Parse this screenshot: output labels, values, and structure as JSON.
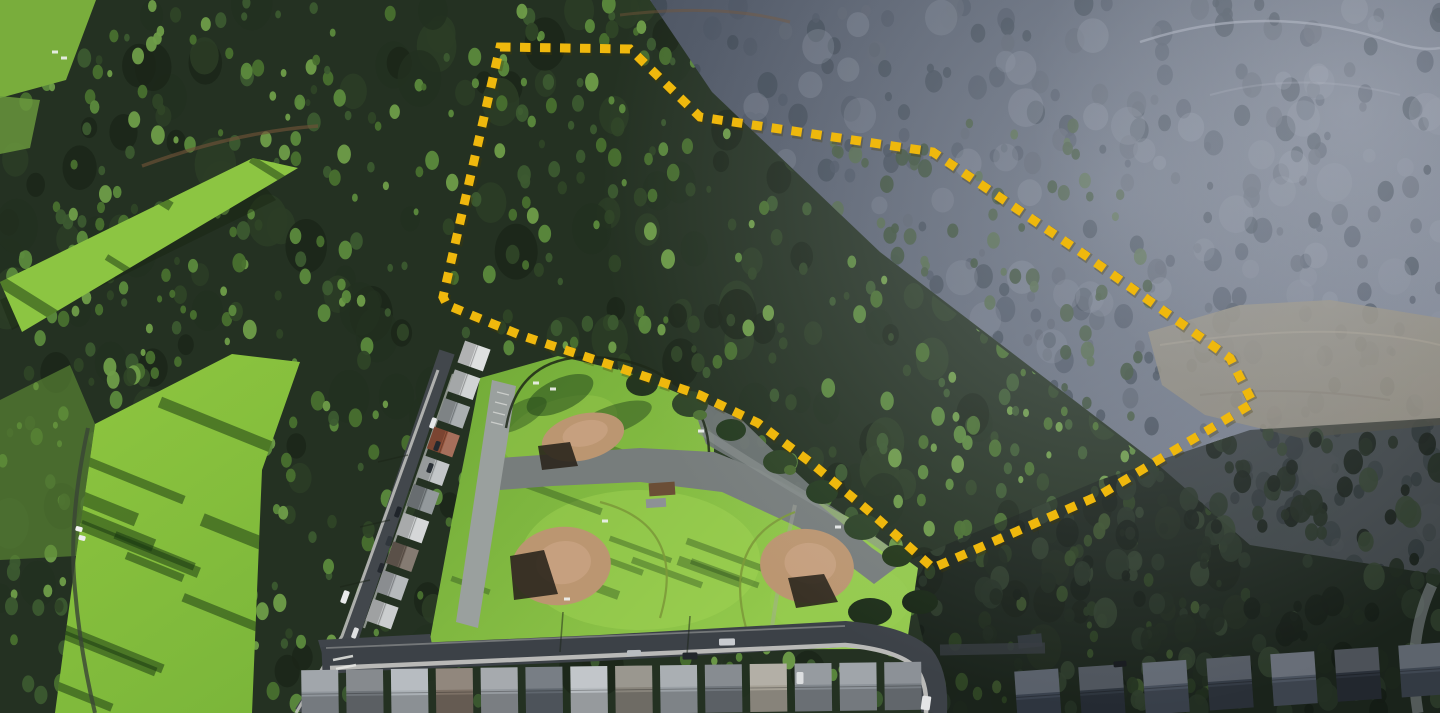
{
  "scene": {
    "type": "aerial-drone-photo",
    "description": "Low-sun aerial photo of a forested hillside parcel outlined with a yellow dashed boundary, above a community ballpark, golf-course fairways and suburban streets",
    "canvas": {
      "width": 1440,
      "height": 713
    }
  },
  "overlay": {
    "boundary": {
      "name": "parcel-boundary",
      "style": "dashed",
      "color": "#efb80d",
      "shadow_color": "#4a3c00",
      "stroke_width": 9,
      "dash_pattern": "10.5 9.5",
      "points": "500,47 630,49 700,117 933,152 1085,255 1230,358 1253,403 1100,495 933,568 870,512 810,462 758,423 700,395 620,368 520,335 447,305 443,297"
    }
  },
  "landmarks": {
    "forest": {
      "label": "dense conifer forest",
      "coverage": "left and center"
    },
    "hillside": {
      "label": "hazy chaparral hillside",
      "coverage": "upper right"
    },
    "bare_patch": {
      "label": "graded bare slope",
      "points": "1148,332 1240,305 1330,300 1440,318 1440,425 1300,438 1205,415 1162,385"
    },
    "golf_course": {
      "label": "golf fairways with tree shadows",
      "fairway_count": 2,
      "cart_count": 2
    },
    "ballpark": {
      "label": "community ballpark",
      "dirt_color": "#bb9671",
      "dirt_light": "#cfa98a",
      "diamonds": [
        {
          "name": "upper-infield",
          "cx": 583,
          "cy": 437,
          "rx": 42,
          "ry": 23,
          "rot": -14
        },
        {
          "name": "lower-left-infield",
          "cx": 561,
          "cy": 566,
          "rx": 50,
          "ry": 39,
          "rot": -8
        },
        {
          "name": "lower-right-infield",
          "cx": 807,
          "cy": 566,
          "rx": 47,
          "ry": 37,
          "rot": 6
        }
      ],
      "backstops": [
        {
          "points": "510,556 544,550 558,594 514,600"
        },
        {
          "points": "788,578 824,574 838,602 796,608"
        },
        {
          "points": "538,446 570,442 578,466 542,470"
        }
      ],
      "sheds": [
        {
          "x": 662,
          "y": 489,
          "w": 26,
          "h": 13,
          "a": -4,
          "c": "#6b4e36"
        },
        {
          "x": 656,
          "y": 503,
          "w": 20,
          "h": 9,
          "a": -4,
          "c": "#8d9195"
        },
        {
          "x": 1030,
          "y": 641,
          "w": 24,
          "h": 13,
          "a": -6,
          "c": "#2e353a"
        }
      ],
      "white_specks": [
        [
          536,
          383
        ],
        [
          553,
          389
        ],
        [
          697,
          400
        ],
        [
          701,
          431
        ],
        [
          605,
          521
        ],
        [
          838,
          527
        ],
        [
          567,
          599
        ],
        [
          55,
          52
        ],
        [
          64,
          58
        ]
      ]
    },
    "house_rows": [
      {
        "name": "bottom-street-row",
        "start": [
          320,
          694
        ],
        "end": [
          903,
          686
        ],
        "count": 14,
        "frontage": 37,
        "depth": 48,
        "angle": -0.8,
        "colors": [
          "#8f959b",
          "#6f7479",
          "#aab0b5",
          "#7c7065",
          "#959a9f",
          "#5f666e",
          "#b7bcc0",
          "#87837a",
          "#9aa0a5",
          "#70767c",
          "#a5a095",
          "#82888e",
          "#8e949a",
          "#777d83"
        ]
      },
      {
        "name": "shaded-right-row",
        "start": [
          1038,
          696
        ],
        "end": [
          1422,
          670
        ],
        "count": 7,
        "frontage": 44,
        "depth": 52,
        "angle": -4,
        "colors": [
          "#39414d",
          "#2d343d",
          "#454d59",
          "#333a44",
          "#4a525e",
          "#2a3039",
          "#3f4752"
        ]
      },
      {
        "name": "side-street-row",
        "start": [
          474,
          356
        ],
        "end": [
          382,
          614
        ],
        "count": 10,
        "frontage": 23,
        "depth": 27,
        "angle": 109.5,
        "colors": [
          "#d8dadb",
          "#c9cccd",
          "#9aa0a3",
          "#96543c",
          "#b8bcbe",
          "#7f8689",
          "#cdd0d1",
          "#6e6258",
          "#a9adb0",
          "#c2c5c6"
        ]
      }
    ],
    "vehicles": [
      {
        "x": 433,
        "y": 423,
        "l": 11,
        "w": 5,
        "a": 110,
        "c": "#e6e8e9"
      },
      {
        "x": 437,
        "y": 446,
        "l": 10,
        "w": 5,
        "a": 110,
        "c": "#23282e"
      },
      {
        "x": 430,
        "y": 468,
        "l": 10,
        "w": 5,
        "a": 110,
        "c": "#2a3036"
      },
      {
        "x": 398,
        "y": 512,
        "l": 11,
        "w": 5,
        "a": 110,
        "c": "#1f242a"
      },
      {
        "x": 389,
        "y": 541,
        "l": 10,
        "w": 5,
        "a": 110,
        "c": "#30363c"
      },
      {
        "x": 381,
        "y": 568,
        "l": 10,
        "w": 5,
        "a": 110,
        "c": "#24292f"
      },
      {
        "x": 345,
        "y": 597,
        "l": 13,
        "w": 6,
        "a": 110,
        "c": "#e9eaeb"
      },
      {
        "x": 355,
        "y": 633,
        "l": 11,
        "w": 5,
        "a": 110,
        "c": "#dfe1e2"
      },
      {
        "x": 727,
        "y": 642,
        "l": 16,
        "w": 7,
        "a": -1,
        "c": "#c9ccd0"
      },
      {
        "x": 690,
        "y": 656,
        "l": 15,
        "w": 7,
        "a": -1,
        "c": "#23272c"
      },
      {
        "x": 634,
        "y": 653,
        "l": 14,
        "w": 6,
        "a": -1,
        "c": "#b8bcc0"
      },
      {
        "x": 800,
        "y": 678,
        "l": 7,
        "w": 12,
        "a": 0,
        "c": "#dcdee0"
      },
      {
        "x": 926,
        "y": 703,
        "l": 9,
        "w": 14,
        "a": 8,
        "c": "#e4e5e6"
      },
      {
        "x": 1120,
        "y": 664,
        "l": 13,
        "w": 6,
        "a": -5,
        "c": "#15181c"
      },
      {
        "x": 79,
        "y": 529,
        "l": 7,
        "w": 5,
        "a": 15,
        "c": "#f2f3f3"
      },
      {
        "x": 82,
        "y": 538,
        "l": 7,
        "w": 5,
        "a": 15,
        "c": "#eceded"
      }
    ]
  },
  "palette": {
    "forest_dark": "#1b2619",
    "forest_mid": "#34502c",
    "forest_lit": "#6f9d49",
    "hillside_slate": "#565e6c",
    "hillside_light": "#8f95a2",
    "bare_soil": "#8d8779",
    "fairway_green": "#86c23f",
    "lawn_green": "#84bb41",
    "lawn_sunlit": "#9ccd52",
    "infield_dirt": "#bb9671",
    "asphalt": "#42474c",
    "parking_gray": "#9aa09e",
    "sidewalk": "#c6c7c3",
    "boundary_yellow": "#efb80d"
  }
}
